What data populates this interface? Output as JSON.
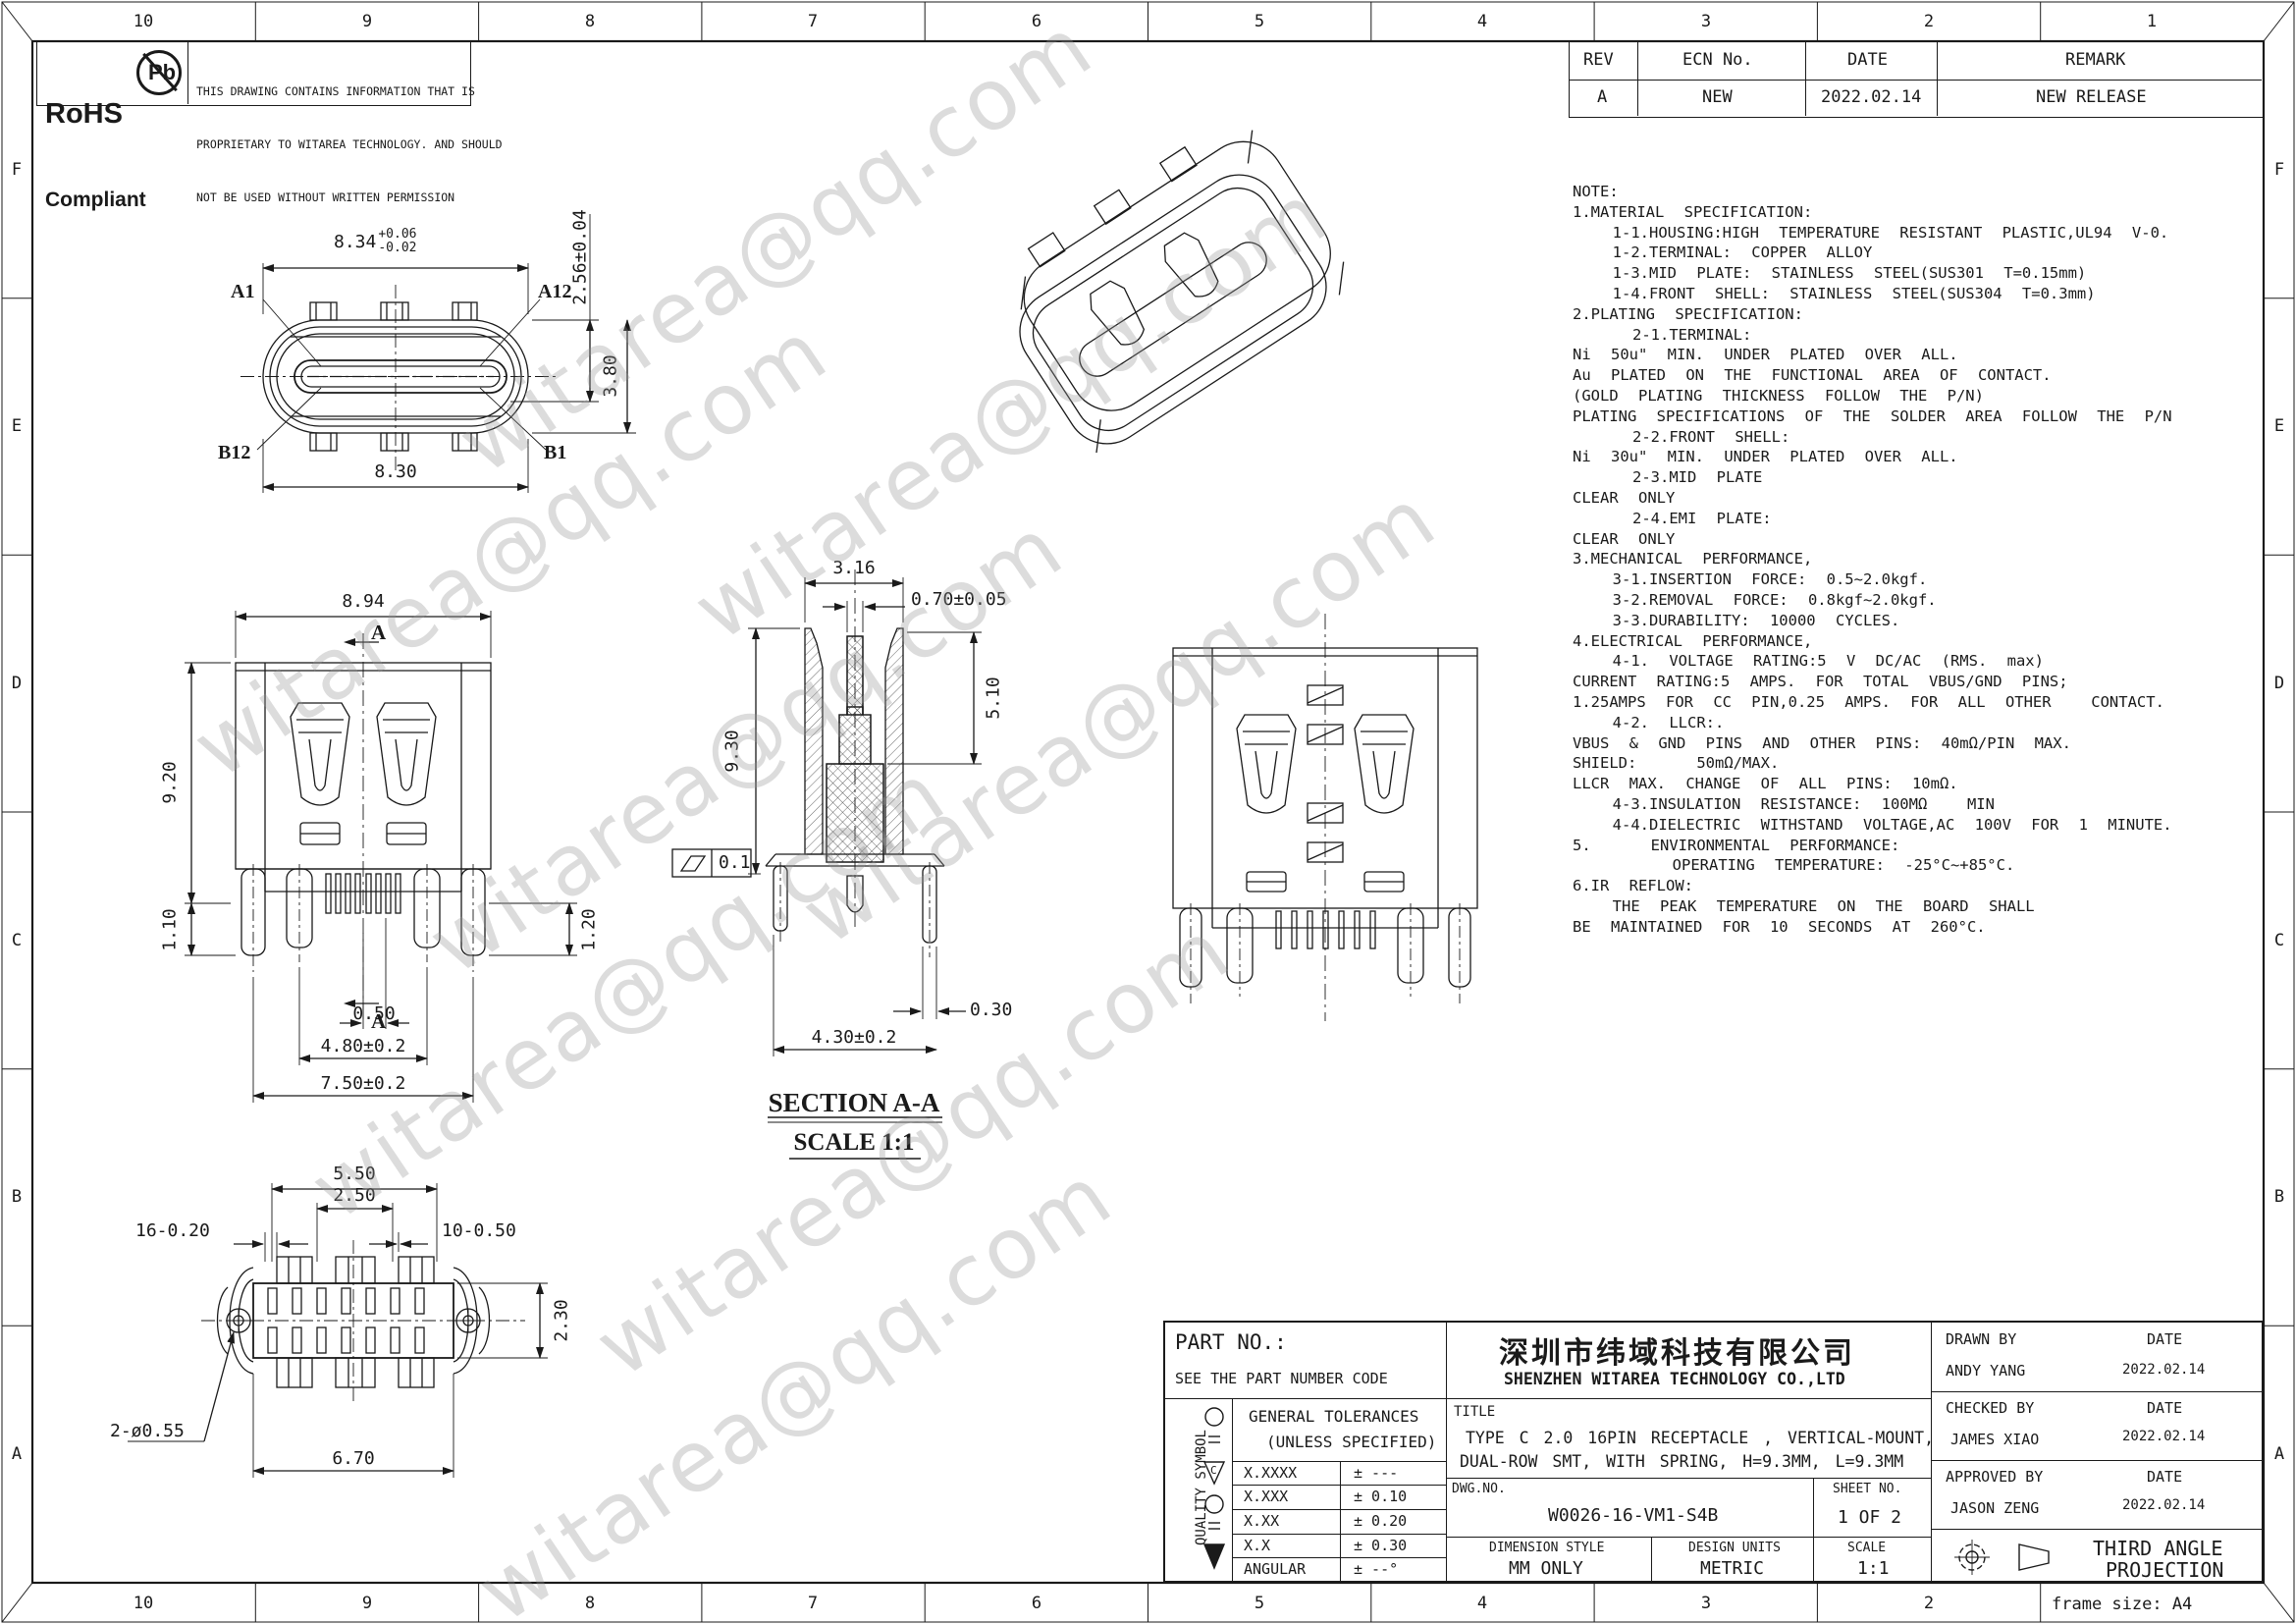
{
  "watermark": "witarea@qq.com",
  "border": {
    "columns": [
      "10",
      "9",
      "8",
      "7",
      "6",
      "5",
      "4",
      "3",
      "2",
      "1"
    ],
    "rows": [
      "F",
      "E",
      "D",
      "C",
      "B",
      "A"
    ],
    "frame_size": "frame size: A4"
  },
  "rohs": {
    "line1": "RoHS",
    "line2": "Compliant",
    "pb": "Pb"
  },
  "proprietary": {
    "line1": "THIS DRAWING CONTAINS INFORMATION THAT IS",
    "line2": "PROPRIETARY TO WITAREA TECHNOLOGY. AND SHOULD",
    "line3": "NOT BE USED WITHOUT WRITTEN PERMISSION"
  },
  "revision_table": {
    "col_rev": "REV",
    "col_ecn": "ECN No.",
    "col_date": "DATE",
    "col_remark": "REMARK",
    "row_rev": "A",
    "row_ecn": "NEW",
    "row_date": "2022.02.14",
    "row_remark": "NEW RELEASE"
  },
  "notes": {
    "lines": [
      "NOTE:",
      "1.MATERIAL SPECIFICATION:",
      "  1-1.HOUSING:HIGH TEMPERATURE RESISTANT PLASTIC,UL94 V-0.",
      "  1-2.TERMINAL: COPPER ALLOY",
      "  1-3.MID PLATE: STAINLESS STEEL(SUS301 T=0.15mm)",
      "  1-4.FRONT SHELL: STAINLESS STEEL(SUS304 T=0.3mm)",
      "2.PLATING SPECIFICATION:",
      "   2-1.TERMINAL:",
      "Ni 50u\" MIN. UNDER PLATED OVER ALL.",
      "Au PLATED ON THE FUNCTIONAL AREA OF CONTACT.",
      "(GOLD PLATING THICKNESS FOLLOW THE P/N)",
      "PLATING SPECIFICATIONS OF THE SOLDER AREA FOLLOW THE P/N",
      "   2-2.FRONT SHELL:",
      "Ni 30u\" MIN. UNDER PLATED OVER ALL.",
      "   2-3.MID PLATE",
      "CLEAR ONLY",
      "   2-4.EMI PLATE:",
      "CLEAR ONLY",
      "3.MECHANICAL PERFORMANCE,",
      "  3-1.INSERTION FORCE: 0.5~2.0kgf.",
      "  3-2.REMOVAL FORCE: 0.8kgf~2.0kgf.",
      "  3-3.DURABILITY: 10000 CYCLES.",
      "4.ELECTRICAL PERFORMANCE,",
      "  4-1. VOLTAGE RATING:5 V DC/AC (RMS. max)",
      "CURRENT RATING:5 AMPS. FOR TOTAL VBUS/GND PINS;",
      "1.25AMPS FOR CC PIN,0.25 AMPS. FOR ALL OTHER  CONTACT.",
      "  4-2. LLCR:.",
      "VBUS & GND PINS AND OTHER PINS: 40mΩ/PIN MAX.",
      "SHIELD:   50mΩ/MAX.",
      "LLCR MAX. CHANGE OF ALL PINS: 10mΩ.",
      "  4-3.INSULATION RESISTANCE: 100MΩ  MIN",
      "  4-4.DIELECTRIC WITHSTAND VOLTAGE,AC 100V FOR 1 MINUTE.",
      "5.   ENVIRONMENTAL PERFORMANCE:",
      "     OPERATING TEMPERATURE: -25°C~+85°C.",
      "6.IR REFLOW:",
      "  THE PEAK TEMPERATURE ON THE BOARD SHALL",
      "BE MAINTAINED FOR 10 SECONDS AT 260°C."
    ]
  },
  "front_view": {
    "dim_width_top": "8.34",
    "tol_plus": "+0.06",
    "tol_minus": "-0.02",
    "dim_tongue_height": "2.56±0.04",
    "dim_body_height": "3.80",
    "dim_width_bottom": "8.30",
    "pin_a1": "A1",
    "pin_a12": "A12",
    "pin_b12": "B12",
    "pin_b1": "B1"
  },
  "side_view": {
    "dim_width": "8.94",
    "dim_height": "9.20",
    "dim_leg": "1.10",
    "dim_pin_offset": "0.50",
    "dim_span_inner": "4.80±0.2",
    "dim_span_outer": "7.50±0.2",
    "dim_leg_right": "1.20",
    "section_mark": "A"
  },
  "section_view": {
    "dim_width": "3.16",
    "dim_pin": "0.70±0.05",
    "dim_height": "9.30",
    "dim_depth": "5.10",
    "flatness": "0.1",
    "dim_leg": "0.30",
    "dim_span": "4.30±0.2",
    "label": "SECTION A-A",
    "scale": "SCALE 1:1"
  },
  "top_view": {
    "dim_pitch_outer": "5.50",
    "dim_pitch_inner": "2.50",
    "dim_pads_left": "16-0.20",
    "dim_pads_right": "10-0.50",
    "dim_row": "2.30",
    "dim_holes": "2-ø0.55",
    "dim_length": "6.70"
  },
  "title_block": {
    "part_no_label": "PART NO.:",
    "part_no_value": "SEE THE PART NUMBER CODE",
    "quality_symbol": "QUALITY SYMBOL",
    "tolerances_title1": "GENERAL TOLERANCES",
    "tolerances_title2": "(UNLESS SPECIFIED)",
    "tol_rows": [
      {
        "r": "X.XXXX",
        "v": "± ---"
      },
      {
        "r": "X.XXX",
        "v": "± 0.10"
      },
      {
        "r": "X.XX",
        "v": "± 0.20"
      },
      {
        "r": "X.X",
        "v": "± 0.30"
      },
      {
        "r": "ANGULAR",
        "v": "± --°"
      }
    ],
    "company_cn": "深圳市纬域科技有限公司",
    "company_en": "SHENZHEN WITAREA TECHNOLOGY CO.,LTD",
    "title_label": "TITLE",
    "title_line1": "TYPE C 2.0 16PIN RECEPTACLE , VERTICAL-MOUNT,",
    "title_line2": "DUAL-ROW SMT, WITH SPRING, H=9.3MM, L=9.3MM",
    "dwg_no_label": "DWG.NO.",
    "dwg_no": "W0026-16-VM1-S4B",
    "sheet_no_label": "SHEET NO.",
    "sheet_no": "1 OF 2",
    "dimension_style_label": "DIMENSION STYLE",
    "dimension_style": "MM ONLY",
    "design_units_label": "DESIGN UNITS",
    "design_units": "METRIC",
    "scale_label": "SCALE",
    "scale": "1:1",
    "drawn_by_label": "DRAWN BY",
    "drawn_by": "ANDY YANG",
    "drawn_date": "2022.02.14",
    "checked_by_label": "CHECKED BY",
    "checked_by": "JAMES XIAO",
    "checked_date": "2022.02.14",
    "approved_by_label": "APPROVED BY",
    "approved_by": "JASON ZENG",
    "approved_date": "2022.02.14",
    "date_label": "DATE",
    "projection_line1": "THIRD ANGLE",
    "projection_line2": "PROJECTION"
  }
}
